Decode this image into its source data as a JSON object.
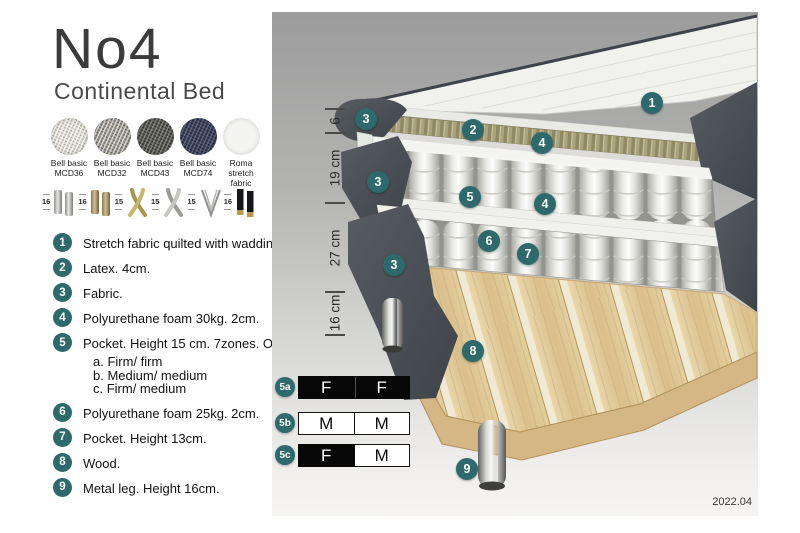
{
  "header": {
    "title": "No4",
    "subtitle": "Continental Bed"
  },
  "fabrics": [
    {
      "name": "Bell basic",
      "code": "MCD36"
    },
    {
      "name": "Bell basic",
      "code": "MCD32"
    },
    {
      "name": "Bell basic",
      "code": "MCD43"
    },
    {
      "name": "Bell basic",
      "code": "MCD74"
    },
    {
      "name": "Roma",
      "code": "stretch fabric"
    }
  ],
  "legs": [
    {
      "height": "16",
      "type": "cylinder-silver-legs"
    },
    {
      "height": "16",
      "type": "cylinder-brass-legs"
    },
    {
      "height": "15",
      "type": "crossed-gold-legs"
    },
    {
      "height": "15",
      "type": "crossed-silver-legs"
    },
    {
      "height": "15",
      "type": "hairpin-leg"
    },
    {
      "height": "16",
      "type": "black-brass-legs"
    }
  ],
  "features": [
    {
      "num": "1",
      "text": "Stretch fabric quilted with wadding."
    },
    {
      "num": "2",
      "text": "Latex. 4cm."
    },
    {
      "num": "3",
      "text": "Fabric."
    },
    {
      "num": "4",
      "text": "Polyurethane foam 30kg. 2cm."
    },
    {
      "num": "5",
      "text": "Pocket. Height 15 cm. 7zones. Option:",
      "options": [
        "a. Firm/ firm",
        "b. Medium/ medium",
        "c. Firm/ medium"
      ]
    },
    {
      "num": "6",
      "text": "Polyurethane foam 25kg. 2cm."
    },
    {
      "num": "7",
      "text": "Pocket. Height 13cm."
    },
    {
      "num": "8",
      "text": "Wood."
    },
    {
      "num": "9",
      "text": "Metal leg. Height 16cm."
    }
  ],
  "diagram": {
    "dimensions": [
      "6",
      "19 cm",
      "27 cm",
      "16 cm"
    ],
    "callouts": [
      "1",
      "2",
      "3",
      "4",
      "5",
      "6",
      "7",
      "8",
      "9"
    ],
    "firmness_rows": [
      {
        "label": "5a",
        "cells": [
          {
            "text": "F",
            "style": "dark"
          },
          {
            "text": "F",
            "style": "dark"
          }
        ]
      },
      {
        "label": "5b",
        "cells": [
          {
            "text": "M",
            "style": "light"
          },
          {
            "text": "M",
            "style": "light"
          }
        ]
      },
      {
        "label": "5c",
        "cells": [
          {
            "text": "F",
            "style": "dark"
          },
          {
            "text": "M",
            "style": "light"
          }
        ]
      }
    ],
    "version": "2022.04"
  },
  "colors": {
    "accent_teal": "#2e6a6b",
    "fabric_dark_gray": "#4a4f55",
    "latex_olive": "#a8a07c",
    "wood": "#dcc094",
    "panel_top": "#9c9c9c",
    "panel_bottom": "#f5f4f2"
  }
}
